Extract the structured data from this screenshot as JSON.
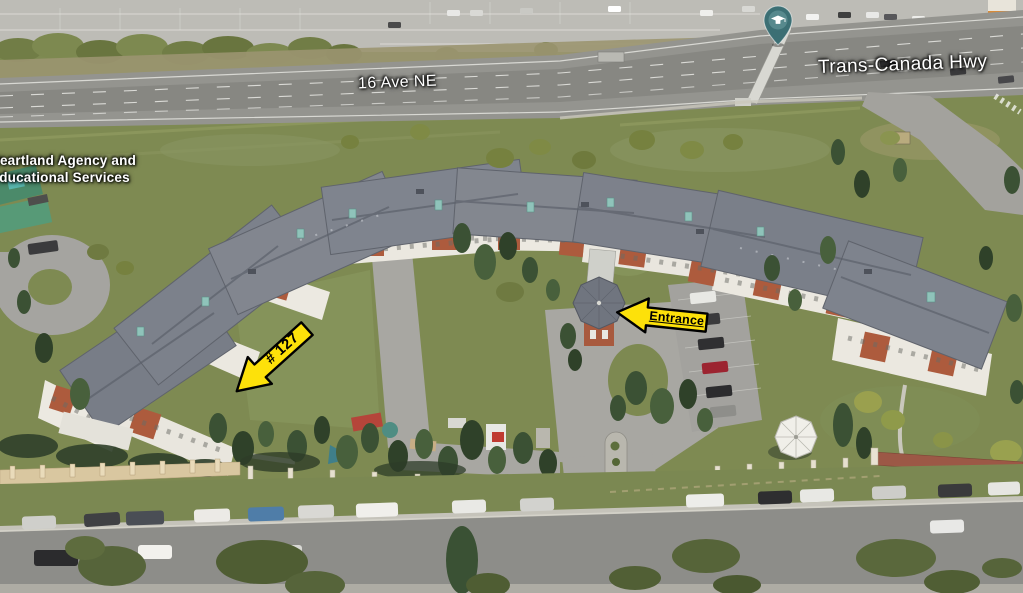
{
  "map_labels": {
    "street": "16 Ave NE",
    "highway": "Trans-Canada Hwy",
    "poi": {
      "line1": "Heartland Agency and",
      "line2": "Educational Services"
    }
  },
  "annotations": {
    "entrance": {
      "label": "Entrance"
    },
    "unit_127": {
      "label": "# 127"
    }
  },
  "icons": {
    "school_pin": "graduation-cap-map-pin"
  },
  "colors": {
    "annotation_yellow": "#fde10a",
    "annotation_outline": "#000000",
    "label_text": "#ffffff",
    "pin_teal": "#3c6f74"
  }
}
